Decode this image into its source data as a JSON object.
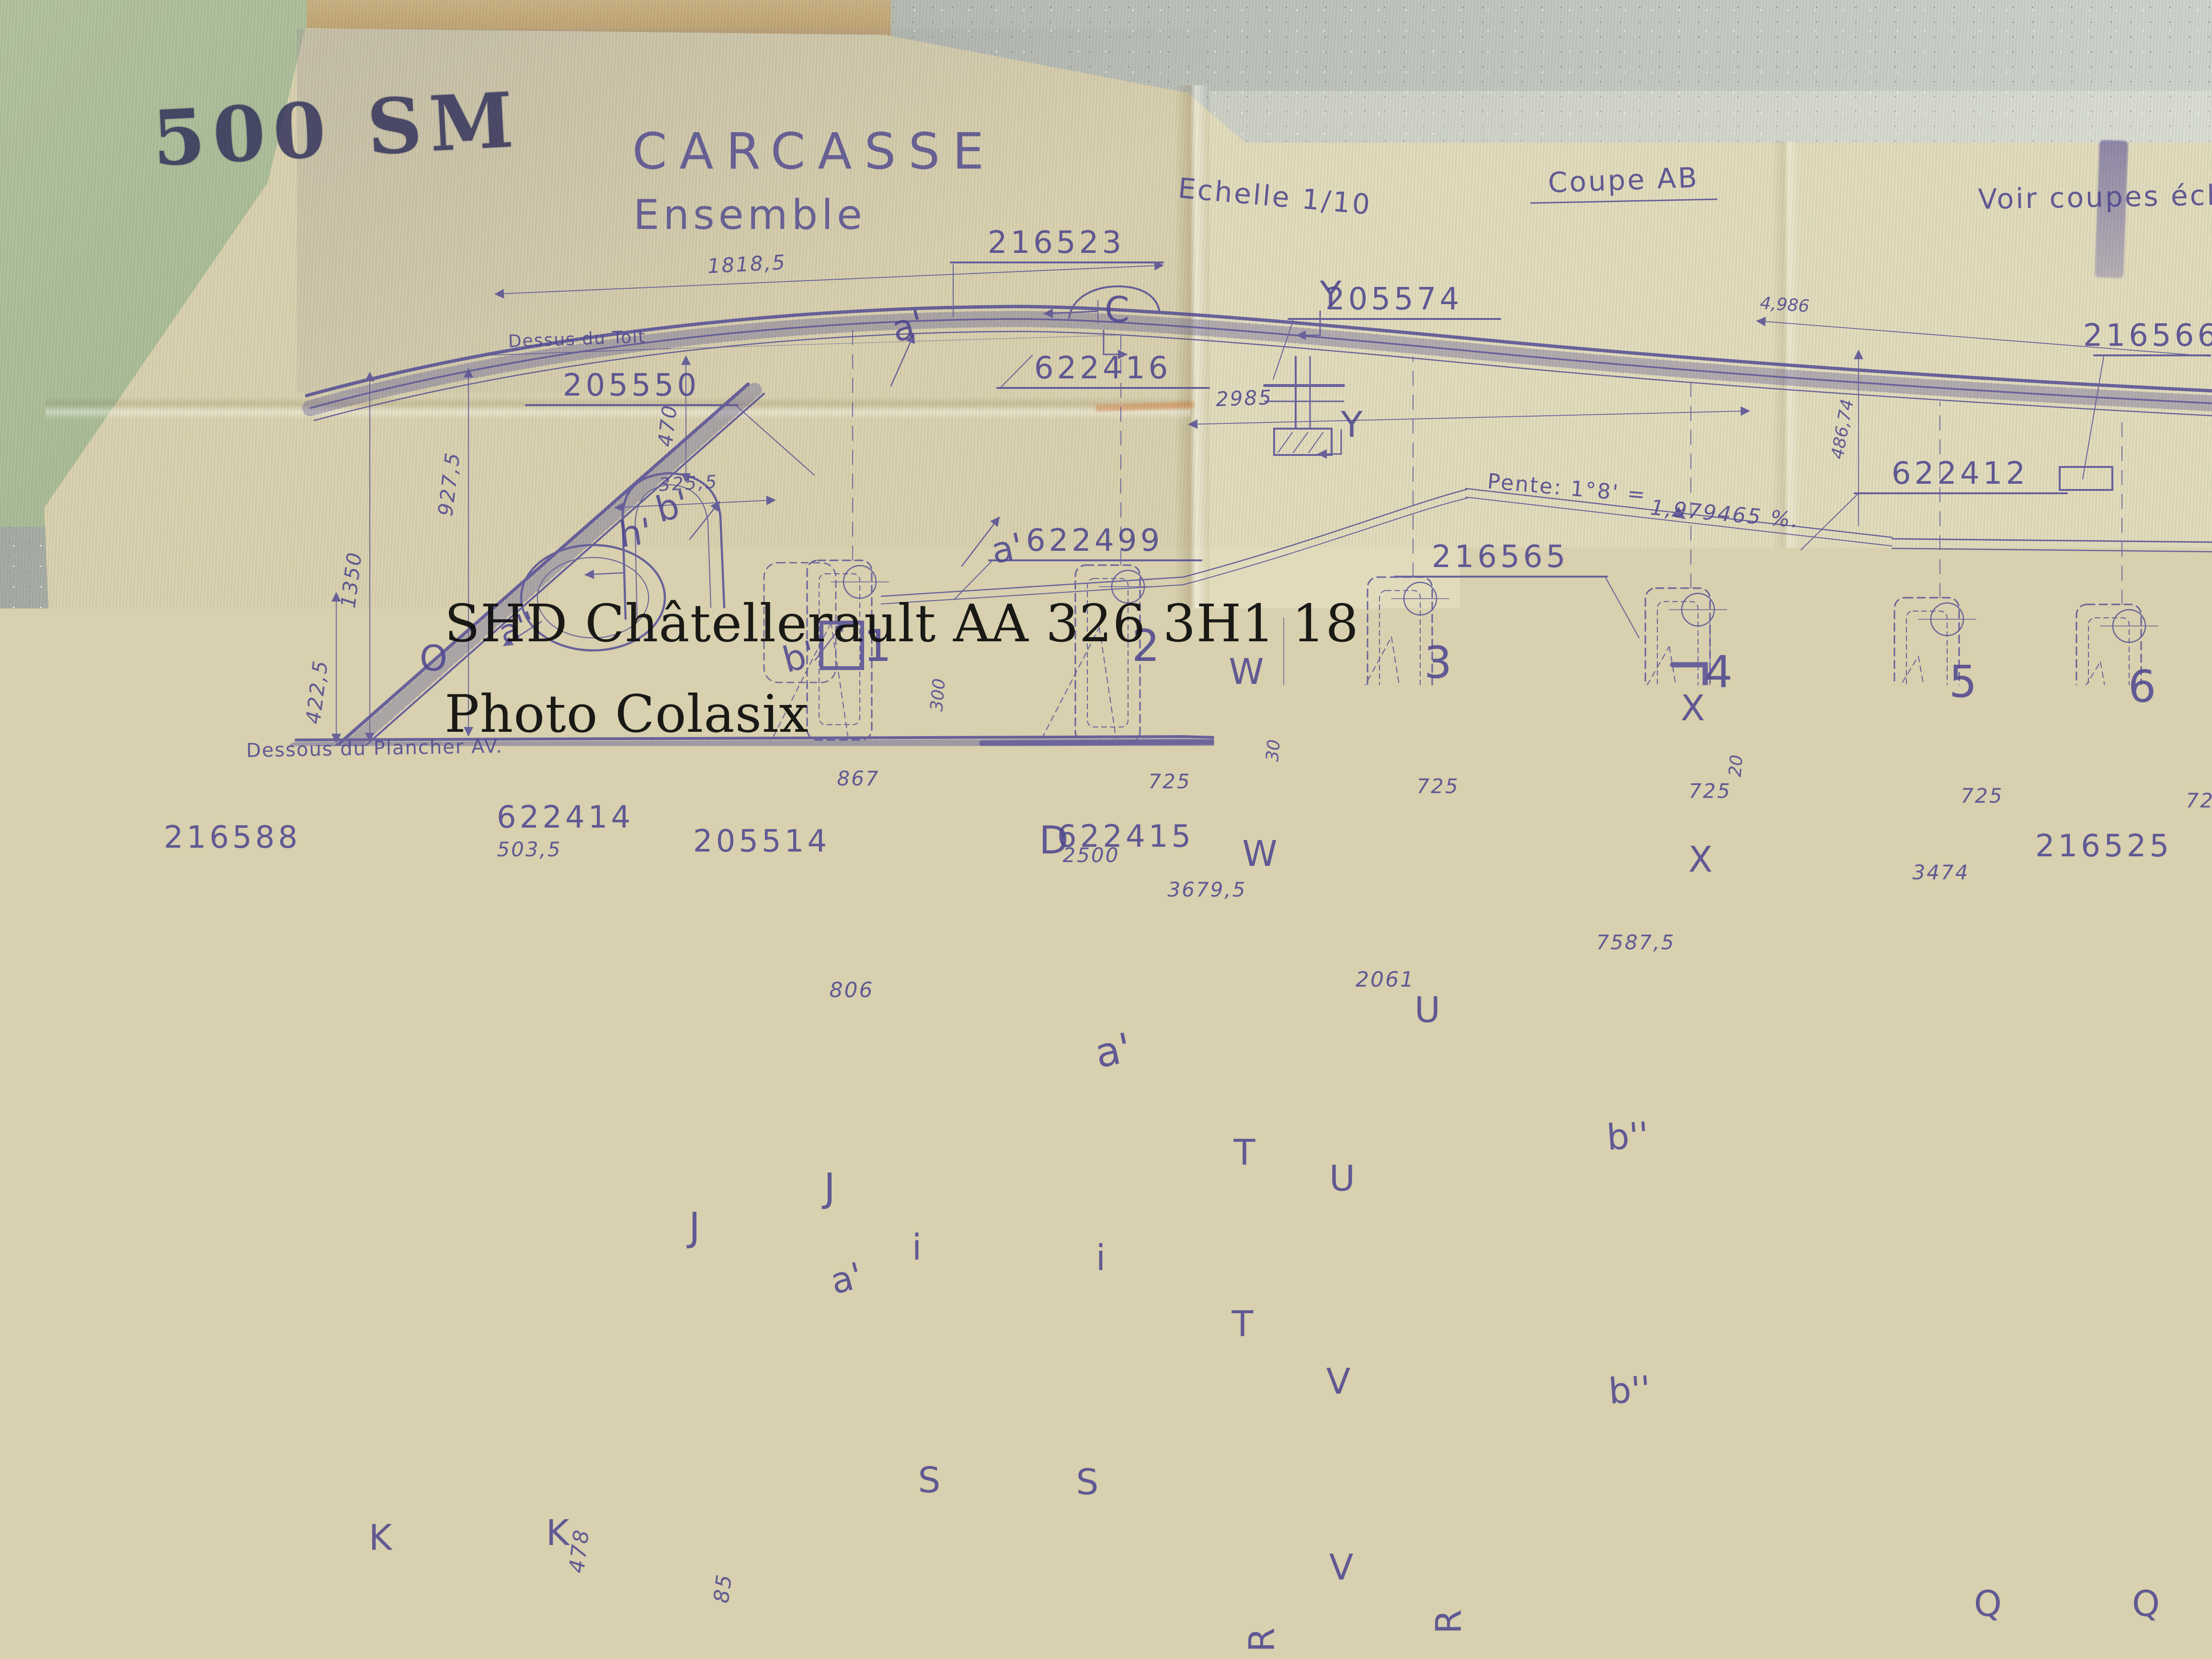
{
  "photo": {
    "stencil": "500 SM",
    "watermark_line1": "SHD Châtellerault AA 326 3H1 18",
    "watermark_line2": "Photo Colasix",
    "ink_color": "#544d96",
    "paper_color": "#d8d0ae",
    "folder_color": "#aec09c",
    "table_color": "#b3b8b0"
  },
  "titles": {
    "main": "CARCASSE",
    "sub": "Ensemble",
    "scale": "Echelle 1/10",
    "section": "Coupe AB",
    "note_right": "Voir coupes éch",
    "roof_ref": "Dessus du Toit",
    "floor_ref": "Dessous du Plancher AV.",
    "slope_a": "Pente: 1°8' =",
    "slope_b": "1,979465 %."
  },
  "parts": {
    "p216523": "216523",
    "p205574": "205574",
    "p216566": "216566",
    "p622416": "622416",
    "p205550": "205550",
    "p622412": "622412",
    "p622499": "622499",
    "p216565": "216565",
    "p216588": "216588",
    "p622414": "622414",
    "p205514": "205514",
    "p622415": "622415",
    "p216525": "216525"
  },
  "dims": {
    "d1818_5": "1818,5",
    "d2985": "2985",
    "d4986": "4,986",
    "d486_74": "486,74",
    "d470": "470",
    "d927_5": "927,5",
    "d1350": "1350",
    "d422_5": "422,5",
    "d325_5": "325,5",
    "d503_5": "503,5",
    "d867": "867",
    "d725": "725",
    "d2500": "2500",
    "d3679_5": "3679,5",
    "d3474": "3474",
    "d7587_5": "7587,5",
    "d806": "806",
    "d2061": "2061",
    "d30": "30",
    "d20": "20",
    "d300": "300",
    "d478": "478",
    "d85": "85"
  },
  "marks": {
    "C": "C",
    "Y": "Y",
    "D": "D",
    "W": "W",
    "X": "X",
    "T": "T",
    "U": "U",
    "V": "V",
    "J": "J",
    "S": "S",
    "K": "K",
    "R": "R",
    "Q": "Q",
    "A": "A",
    "O": "O",
    "i": "i",
    "a_prime": "a'",
    "b_prime": "b'",
    "h_prime": "h'",
    "a_double": "a''",
    "b_double": "b''",
    "n1": "1",
    "n2": "2",
    "n3": "3",
    "n4": "4",
    "n5": "5",
    "n6": "6"
  }
}
